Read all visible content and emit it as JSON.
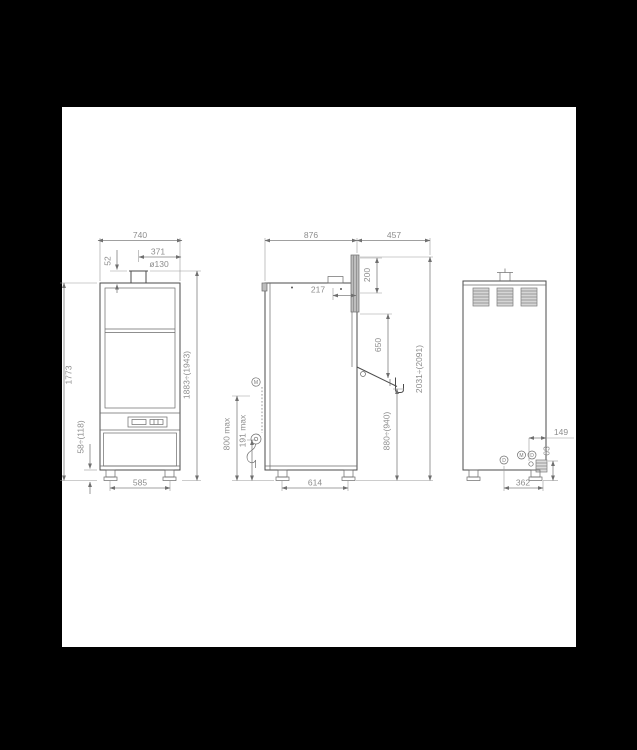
{
  "style": {
    "background": "#000000",
    "sheet": "#ffffff",
    "line_color": "#4b4b4b",
    "dimension_color": "#8d8d8d"
  },
  "drawing": {
    "front_view": {
      "width_top": "740",
      "flue_offset": "371",
      "flue_diameter": "ø130",
      "flue_gap": "52",
      "body_height": "1773",
      "feet_adjust": "58÷(118)",
      "total_height": "1883÷(1943)",
      "feet_width": "585"
    },
    "side_view": {
      "depth": "876",
      "hood_depth": "457",
      "hood_panel_height": "200",
      "handle_offset": "217",
      "hood_clearance": "650",
      "table_height": "880÷(940)",
      "open_height": "2031÷(2091)",
      "drain_loop_max": "800 max",
      "drain_outlet_max": "191 max",
      "feet_depth": "614",
      "connection_symbol": "M"
    },
    "rear_view": {
      "drain_offset": "149",
      "drain_height": "63",
      "feet_width": "362",
      "connection_left": "D",
      "connection_mid": "M",
      "connection_right": "D"
    }
  }
}
